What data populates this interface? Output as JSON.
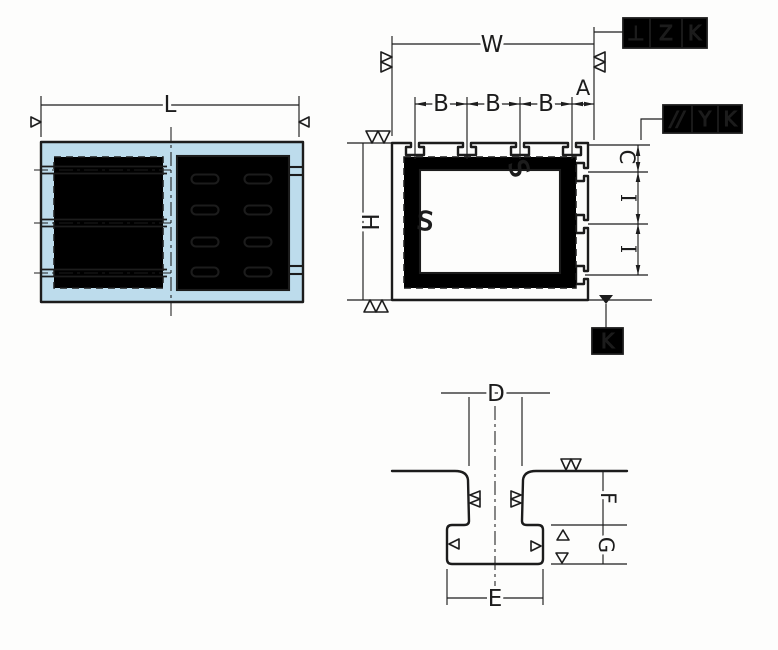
{
  "colors": {
    "part_fill": "#bddcec",
    "line_color": "#1c1c1c",
    "background": "#fdfdfc"
  },
  "front_view": {
    "length_label": "L"
  },
  "plan_view": {
    "width_label": "W",
    "height_label": "H",
    "slot_pitch_label": "B",
    "edge_distance_label": "A",
    "first_row_offset_label": "C",
    "row_pitch_label": "I",
    "surface_mark": "S"
  },
  "section_view": {
    "slot_opening_width_label": "D",
    "slot_bottom_width_label": "E",
    "slot_opening_depth_label": "F",
    "slot_undercut_depth_label": "G"
  },
  "feature_control_frames": {
    "perpendicularity": {
      "symbol": "⊥",
      "tolerance_zone": "Z",
      "datum_ref": "K"
    },
    "parallelism": {
      "symbol": "//",
      "tolerance_zone": "Y",
      "datum_ref": "K"
    },
    "datum_label": "K"
  }
}
